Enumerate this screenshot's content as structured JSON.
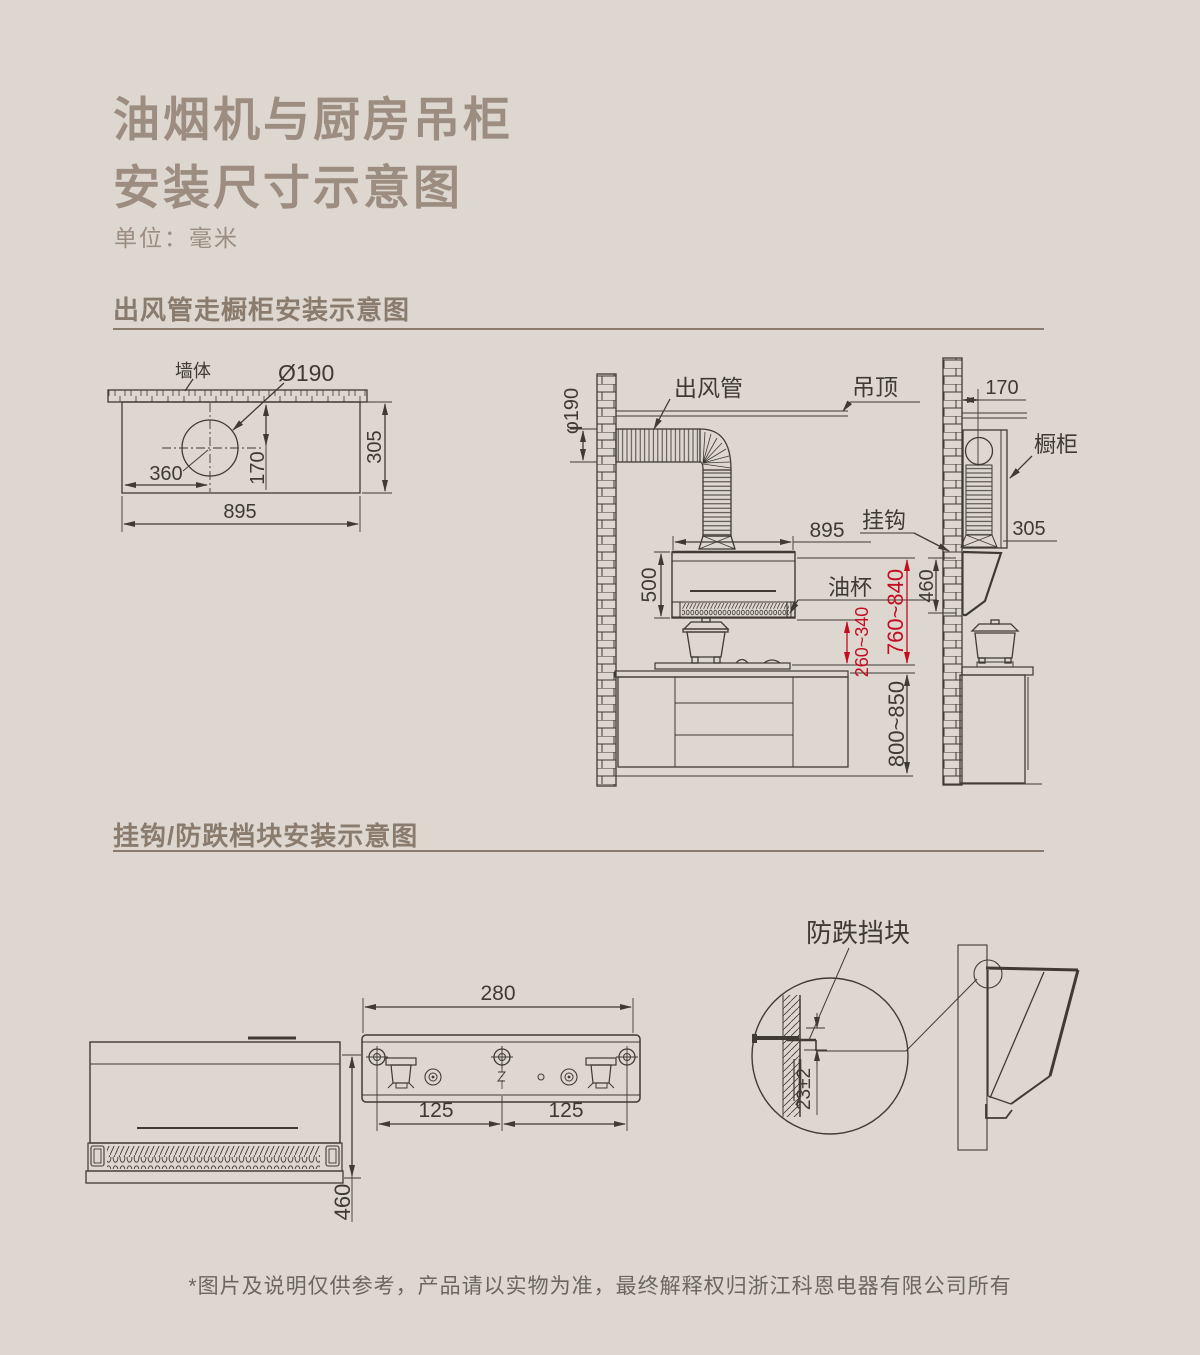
{
  "page": {
    "title_line1": "油烟机与厨房吊柜",
    "title_line2": "安装尺寸示意图",
    "unit_label": "单位：毫米",
    "footer_note": "*图片及说明仅供参考，产品请以实物为准，最终解释权归浙江科恩电器有限公司所有"
  },
  "colors": {
    "background": "#ddd7d0",
    "title_text": "#9c8d80",
    "section_heading": "#8a7b6d",
    "line_art": "#3f3a34",
    "dimension_highlight": "#c40d20"
  },
  "duct_section": {
    "heading": "出风管走橱柜安装示意图",
    "top_view": {
      "wall_label": "墙体",
      "hole_diameter": "Ø190",
      "hole_offset_from_left": "360",
      "hole_offset_from_wall": "170",
      "hood_depth": "305",
      "hood_width": "895"
    },
    "front_view": {
      "duct_label": "出风管",
      "ceiling_label": "吊顶",
      "duct_diameter": "φ190",
      "hood_width": "895",
      "hood_height": "500",
      "oil_cup_label": "油杯",
      "hood_bottom_to_cooktop": "260~340",
      "hood_top_to_cooktop": "760~840",
      "counter_height": "800~850"
    },
    "side_view": {
      "wall_to_duct_center": "170",
      "cabinet_label": "橱柜",
      "hook_label": "挂钩",
      "cabinet_depth": "305",
      "hood_height": "460"
    }
  },
  "hook_section": {
    "heading": "挂钩/防跌档块安装示意图",
    "front_view": {
      "hood_height": "460"
    },
    "bracket_view": {
      "overall_width": "280",
      "pitch_left": "125",
      "pitch_right": "125"
    },
    "detail_view": {
      "block_label": "防跌挡块",
      "hook_clearance": "23±2"
    }
  }
}
